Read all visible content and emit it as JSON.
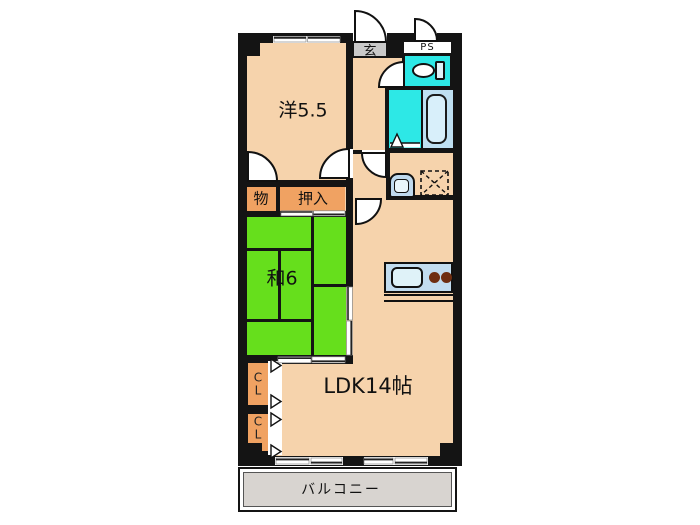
{
  "floorplan": {
    "type": "apartment-floorplan",
    "rooms": {
      "western": {
        "label": "洋5.5"
      },
      "japanese": {
        "label": "和6"
      },
      "ldk": {
        "label": "LDK14帖"
      },
      "balcony": {
        "label": "バルコニー"
      },
      "entrance": {
        "label": "玄"
      },
      "pipe_space": {
        "label": "PS"
      },
      "storage": {
        "label": "物"
      },
      "oshiire": {
        "label": "押入"
      },
      "closet_upper": {
        "char1": "C",
        "char2": "L"
      },
      "closet_lower": {
        "char1": "C",
        "char2": "L"
      }
    },
    "fixtures": [
      "toilet",
      "bathtub",
      "washbasin",
      "washing-machine-space",
      "kitchen-sink",
      "stove-burners",
      "door-swings",
      "sliding-doors"
    ],
    "colors": {
      "wall": "#141414",
      "floor": "#F6D3AC",
      "tatami": "#66DF1C",
      "closet": "#F0A262",
      "wetcyan": "#2DE8E6",
      "tubzone": "#BFE0F2",
      "tub": "#D8EFFA",
      "counter": "#C2DCEF",
      "sink": "#DFF2F8",
      "burner": "#6F2D10",
      "balcony": "#D8D4D0",
      "step": "#C9C9C9",
      "basin": "#BFD9EE"
    }
  }
}
